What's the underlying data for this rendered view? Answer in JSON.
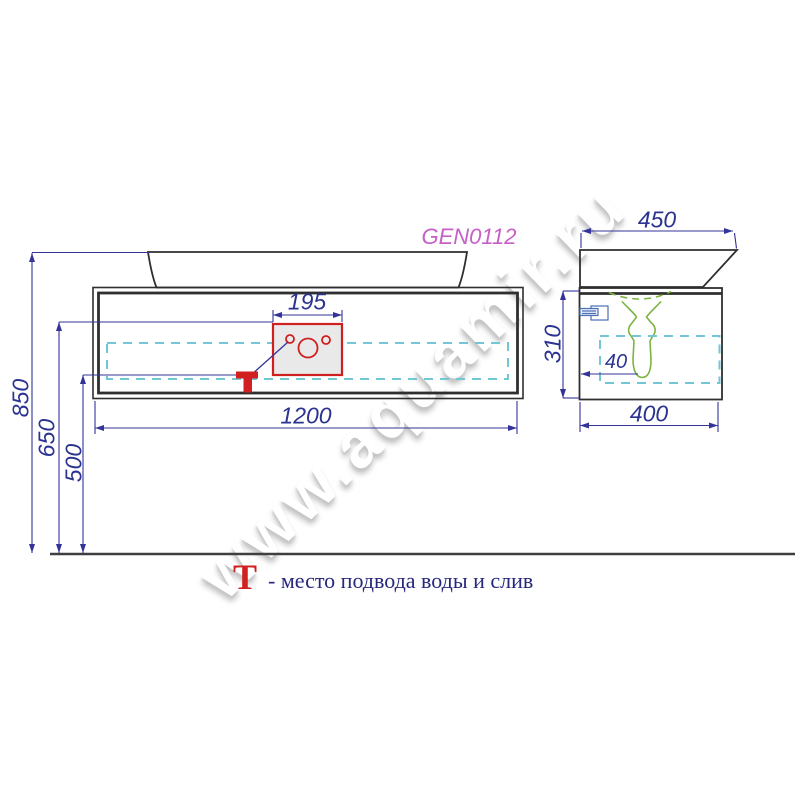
{
  "product": {
    "code": "GEN0112"
  },
  "watermark": {
    "text": "www.aquamir.ru"
  },
  "dimensions": {
    "front_width": "1200",
    "overall_height": "850",
    "connection_zone_top": "650",
    "connection_height": "500",
    "cutout_width": "195",
    "basin_depth": "450",
    "cabinet_depth": "400",
    "cabinet_height": "310",
    "back_clearance": "40"
  },
  "legend": {
    "symbol": "T",
    "description": "- место подвода воды и слив"
  },
  "colors": {
    "outline": "#2f2f2f",
    "dimension_blue": "#2b3390",
    "accent_red": "#d21f1f",
    "drawer_dashed_cyan": "#72c7d7",
    "siphon_green": "#7cb342",
    "product_code_magenta": "#c75fc7"
  }
}
